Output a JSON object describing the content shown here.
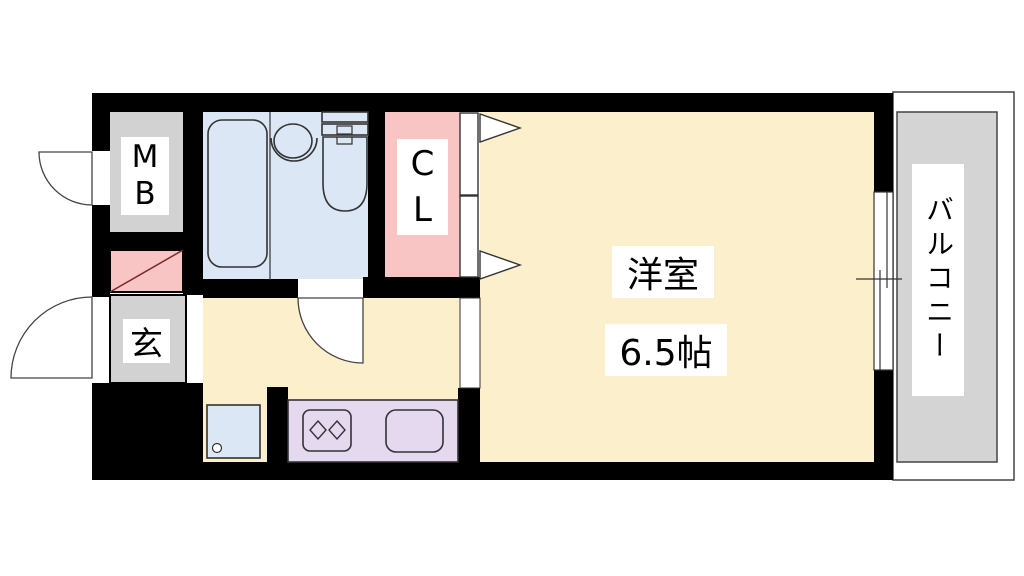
{
  "floor_plan": {
    "meter_box_label": "M\nB",
    "closet_label": "C\nL",
    "entrance_label": "玄",
    "main_room_name": "洋室",
    "main_room_size": "6.5帖",
    "balcony_label": "バルコニー",
    "colors": {
      "wall_black": "#000000",
      "floor_cream": "#FCEFCC",
      "bathroom_blue": "#DCE7F5",
      "closet_pink": "#F8C4C4",
      "gray_area": "#D2D2D2",
      "balcony_gray": "#D4D4D4",
      "counter_purple": "#E4D9EF",
      "line": "#333333",
      "white": "#FFFFFF"
    }
  }
}
